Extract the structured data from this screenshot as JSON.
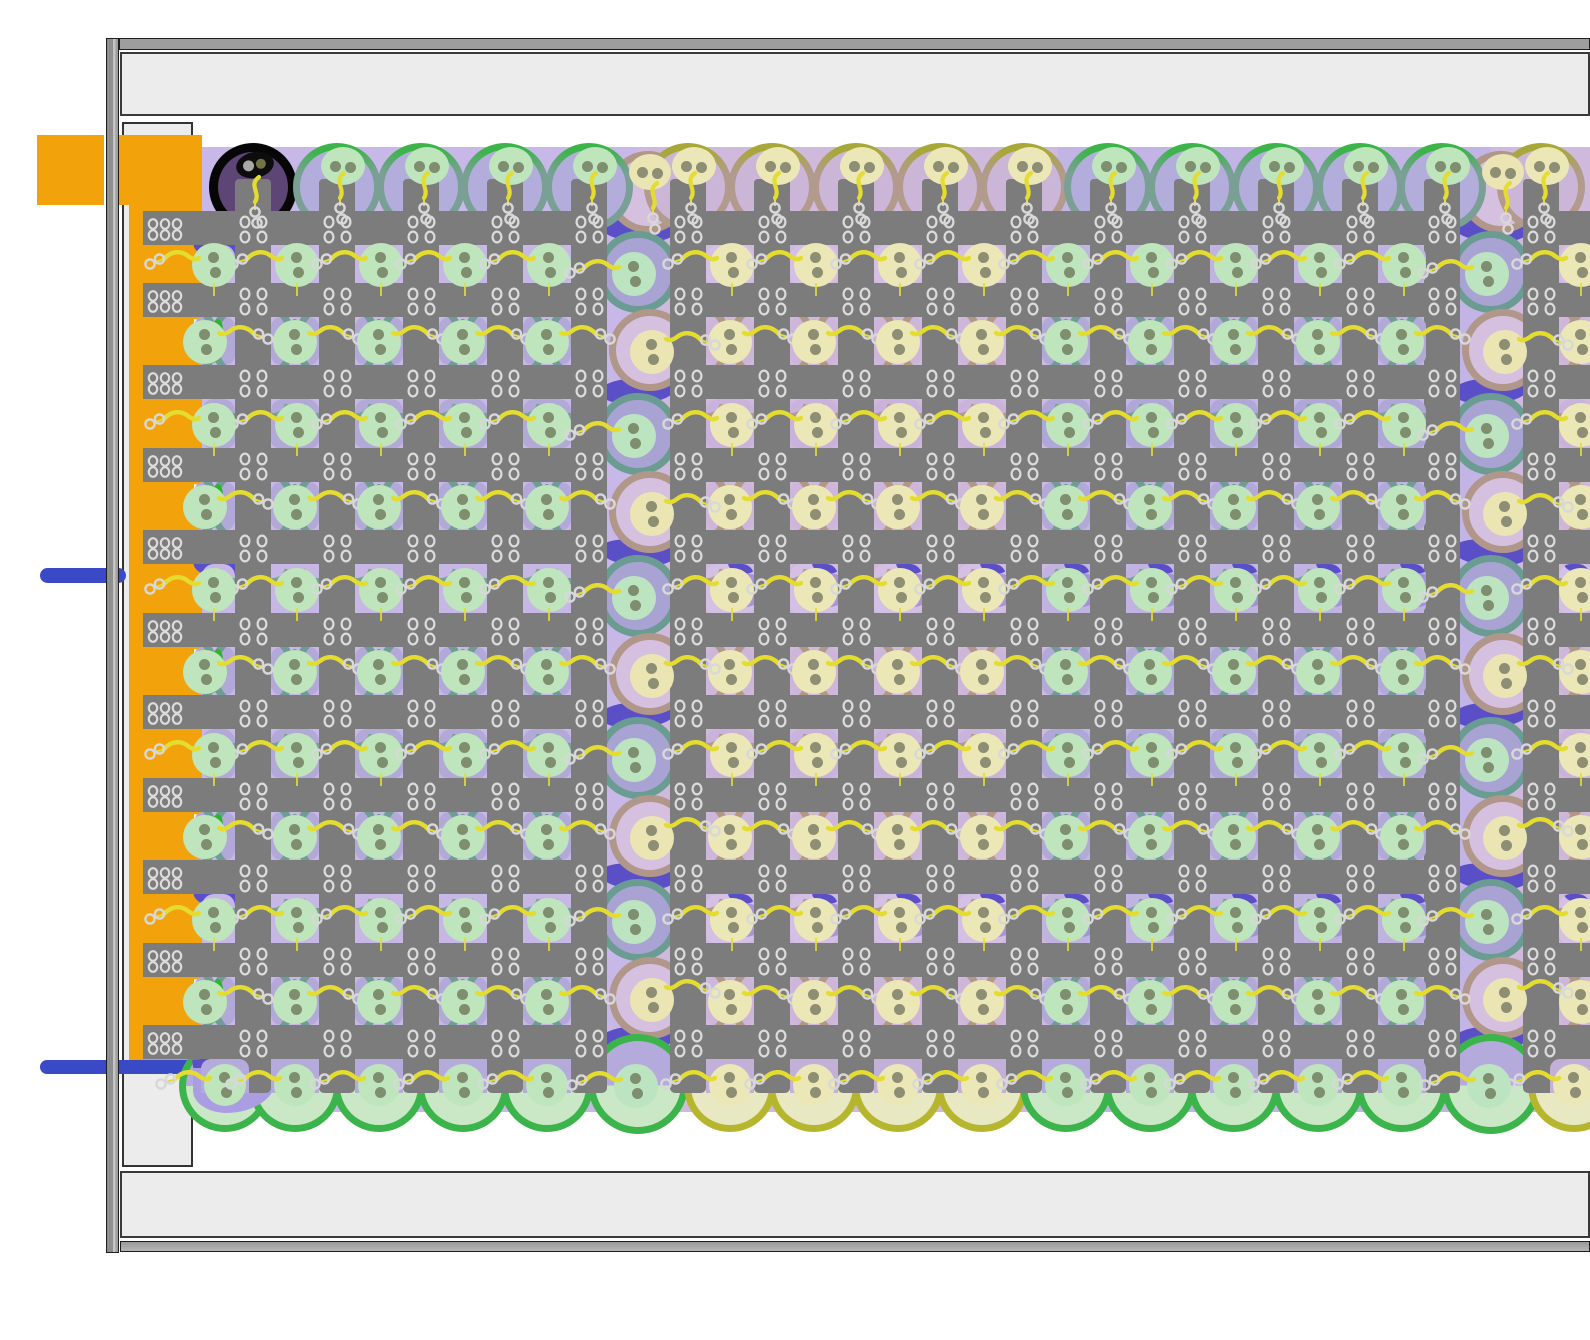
{
  "scene": {
    "w": 1590,
    "h": 1340,
    "bg": "#ffffff"
  },
  "frame": {
    "outline": "#1d1d1d",
    "left_bar": {
      "x": 106,
      "y": 38,
      "w": 13,
      "h": 1215,
      "fill_l": "#8e8e8e",
      "fill_m": "#c4c4c4",
      "fill_r": "#9e9e9e"
    },
    "top_bar": {
      "x": 119,
      "y": 38,
      "w": 1471,
      "h": 12,
      "fill": "#9e9e9e"
    },
    "top_band": {
      "x": 120,
      "y": 52,
      "w": 1470,
      "h": 64,
      "fill": "#ececec",
      "border": "#3a3a3a"
    },
    "bottom_band": {
      "x": 120,
      "y": 1171,
      "w": 1470,
      "h": 67,
      "fill": "#ececec",
      "border": "#3a3a3a"
    },
    "bottom_bar": {
      "x": 120,
      "y": 1241,
      "w": 1470,
      "h": 11,
      "fill": "#9a9a9a"
    },
    "side_box": {
      "x": 122,
      "y": 122,
      "w": 71,
      "h": 1045,
      "fill": "#ececec",
      "border": "#333333"
    }
  },
  "machine": {
    "orange": "#f2a20a",
    "tab": {
      "x": 37,
      "y": 135,
      "w": 67,
      "h": 70
    },
    "band": {
      "x": 119,
      "y": 135,
      "w": 83,
      "h": 70
    },
    "column": {
      "x": 129,
      "y": 135,
      "w": 73,
      "h": 925
    },
    "pipe_color": "#3a4ac6",
    "pipes": [
      {
        "x": 40,
        "y": 568,
        "w": 86,
        "h": 15,
        "r": 8
      },
      {
        "x": 40,
        "y": 1060,
        "w": 154,
        "h": 14,
        "r": 7
      }
    ]
  },
  "lattice": {
    "color": "#7c7c7c",
    "bar_h": 34,
    "vbar_w": 36,
    "vbar_top": 179,
    "vbar_bottom": 1093,
    "hbar_ys": [
      211,
      283,
      365,
      448,
      530,
      613,
      695,
      778,
      860,
      943,
      1025
    ],
    "hbar_segs": [
      [
        143,
        607
      ],
      [
        670,
        1460
      ],
      [
        1523,
        1590
      ]
    ],
    "rivet_stroke": "#dcdcdc",
    "left_rivet_x": 148
  },
  "field": {
    "top": 147,
    "bottom": 1112,
    "left": 194,
    "right": 1590
  },
  "gaps": [
    {
      "y": 245,
      "h": 38,
      "t": "sq"
    },
    {
      "y": 317,
      "h": 48,
      "t": "arc"
    },
    {
      "y": 399,
      "h": 49,
      "t": "sq"
    },
    {
      "y": 482,
      "h": 48,
      "t": "arc"
    },
    {
      "y": 564,
      "h": 49,
      "t": "sq"
    },
    {
      "y": 647,
      "h": 48,
      "t": "arc"
    },
    {
      "y": 729,
      "h": 49,
      "t": "sq"
    },
    {
      "y": 812,
      "h": 48,
      "t": "arc"
    },
    {
      "y": 894,
      "h": 49,
      "t": "sq"
    },
    {
      "y": 977,
      "h": 48,
      "t": "arc"
    }
  ],
  "bottom_row": {
    "patch_y": 1059,
    "patch_h": 34,
    "circle_y": 1086,
    "r": 46,
    "nuc_y": 1085
  },
  "top_row": {
    "cy": 187,
    "r": 44,
    "nuc_dy": -21
  },
  "blocks": [
    {
      "id": "A",
      "bg": "#c8b8e8",
      "bgx": [
        194,
        637
      ],
      "vbars": [
        235,
        319,
        403,
        487,
        571
      ],
      "holes": [
        271,
        355,
        439,
        523
      ],
      "partial": {
        "side": "left",
        "x": 202,
        "w": 33,
        "nuc_cx": 214
      },
      "tops": [
        253,
        337,
        421,
        505,
        589
      ],
      "bots": [
        225,
        295,
        379,
        463,
        547
      ],
      "ring_top": "#3cb44a",
      "ring_side": "#7aa096",
      "top_fill": "#b3addb",
      "arc_ring": "#6f9c94",
      "arc_fill": "#b2a9d9",
      "crescent": "#2db32d",
      "nuc": "#bee5bc",
      "dot": "#7e8e6e",
      "patch_a": "#c6b7e4",
      "patch_b": "#b2a9d9",
      "blob": "",
      "bot_ring": "#3cb44c",
      "bot_fill": "#cae8c6",
      "bot_top": "#b4abdc",
      "first_top_special": true
    },
    {
      "id": "B",
      "bg": "#cfbade",
      "bgx": [
        637,
        1058
      ],
      "vbars": [
        670,
        754,
        838,
        922,
        1006
      ],
      "holes": [
        706,
        790,
        874,
        958
      ],
      "partial": null,
      "tops": [
        688,
        772,
        856,
        940,
        1024
      ],
      "bots": [
        730,
        814,
        898,
        982
      ],
      "ring_top": "#a8a838",
      "ring_side": "#b29a8c",
      "top_fill": "#cbb6d8",
      "arc_ring": "#b29789",
      "arc_fill": "#cdb6da",
      "crescent": "#bac95e",
      "nuc": "#ece7b6",
      "dot": "#8e8e74",
      "patch_a": "#d4c0e4",
      "patch_b": "#c9b2dc",
      "blob": "#aa93da",
      "bot_ring": "#b6b62e",
      "bot_fill": "#e8e8c2",
      "bot_top": "#c2b0d8",
      "first_top_special": false
    },
    {
      "id": "C",
      "bg": "#c2b5e6",
      "bgx": [
        1058,
        1491
      ],
      "vbars": [
        1090,
        1174,
        1258,
        1342,
        1424
      ],
      "holes": [
        1042,
        1126,
        1210,
        1294,
        1378
      ],
      "partial": null,
      "tops": [
        1108,
        1192,
        1276,
        1360,
        1442
      ],
      "bots": [
        1066,
        1150,
        1234,
        1318,
        1402
      ],
      "ring_top": "#3cb44a",
      "ring_side": "#7aa096",
      "top_fill": "#b3addb",
      "arc_ring": "#6f9c94",
      "arc_fill": "#b2a9d9",
      "crescent": "#2db32d",
      "nuc": "#bee5bc",
      "dot": "#7e8e6e",
      "patch_a": "#c0b3e0",
      "patch_b": "#afa7d8",
      "blob": "#a392d8",
      "bot_ring": "#3cb44c",
      "bot_fill": "#cae8c6",
      "bot_top": "#b4abdc",
      "first_top_special": false
    },
    {
      "id": "D",
      "bg": "#cfbade",
      "bgx": [
        1491,
        1590
      ],
      "vbars": [
        1523
      ],
      "holes": [],
      "partial": {
        "side": "right",
        "x": 1559,
        "w": 31,
        "nuc_cx": 1581
      },
      "tops": [
        1541
      ],
      "bots": [
        1574
      ],
      "ring_top": "#a8a838",
      "ring_side": "#b29a8c",
      "top_fill": "#cbb6d8",
      "arc_ring": "#b29789",
      "arc_fill": "#cdb6da",
      "crescent": "#bac95e",
      "nuc": "#ece7b6",
      "dot": "#8e8e74",
      "patch_a": "#d4c0e4",
      "patch_b": "#c9b2dc",
      "blob": "#aa93da",
      "bot_ring": "#b6b62e",
      "bot_fill": "#e8e8c2",
      "bot_top": "#c2b0d8",
      "first_top_special": false
    }
  ],
  "strips": [
    {
      "cx": 638
    },
    {
      "cx": 1491
    }
  ],
  "strip_style": {
    "indigo": "#5b4fc8",
    "teal_ring": "#6b9c92",
    "teal_fill": "#a9a3d3",
    "brown_ring": "#b0978a",
    "brown_fill": "#d6c0e0",
    "nuc_teal": "#bce4c0",
    "nuc_brown": "#eae5b2",
    "dot": "#7e8e6e",
    "dot_b": "#8e8e74",
    "indigo_ys": [
      216,
      378,
      540,
      702,
      864,
      1026
    ],
    "teal_ys": [
      272,
      434,
      596,
      758,
      920
    ],
    "brown_ys": [
      350,
      512,
      674,
      836,
      998
    ],
    "top_brown_y": 192,
    "bottom_y": 1084,
    "r": 41,
    "bot_ring": "#3cb44c",
    "bot_fill": "#cae8c6"
  },
  "black_cell": {
    "cx": 253,
    "cy": 187,
    "r": 44,
    "ring": "#060606",
    "fill": "#5d4575",
    "nuc": "#0d0d0d",
    "dot_light": "#a8a8a8",
    "dot_dark": "#73734a"
  },
  "waves": {
    "indigo": "#5b4fc8",
    "light": "#ab9de2",
    "left_indigo_gap_idx": [
      0,
      4,
      8
    ],
    "bottom_indigo": {
      "x": 193,
      "y": 1057,
      "w": 48,
      "h": 16
    },
    "bottom_light": {
      "x": 193,
      "y": 1068,
      "w": 84,
      "h": 45
    }
  },
  "tail": {
    "yellow": "#e4dd30",
    "ring": "#d8d8d8"
  }
}
